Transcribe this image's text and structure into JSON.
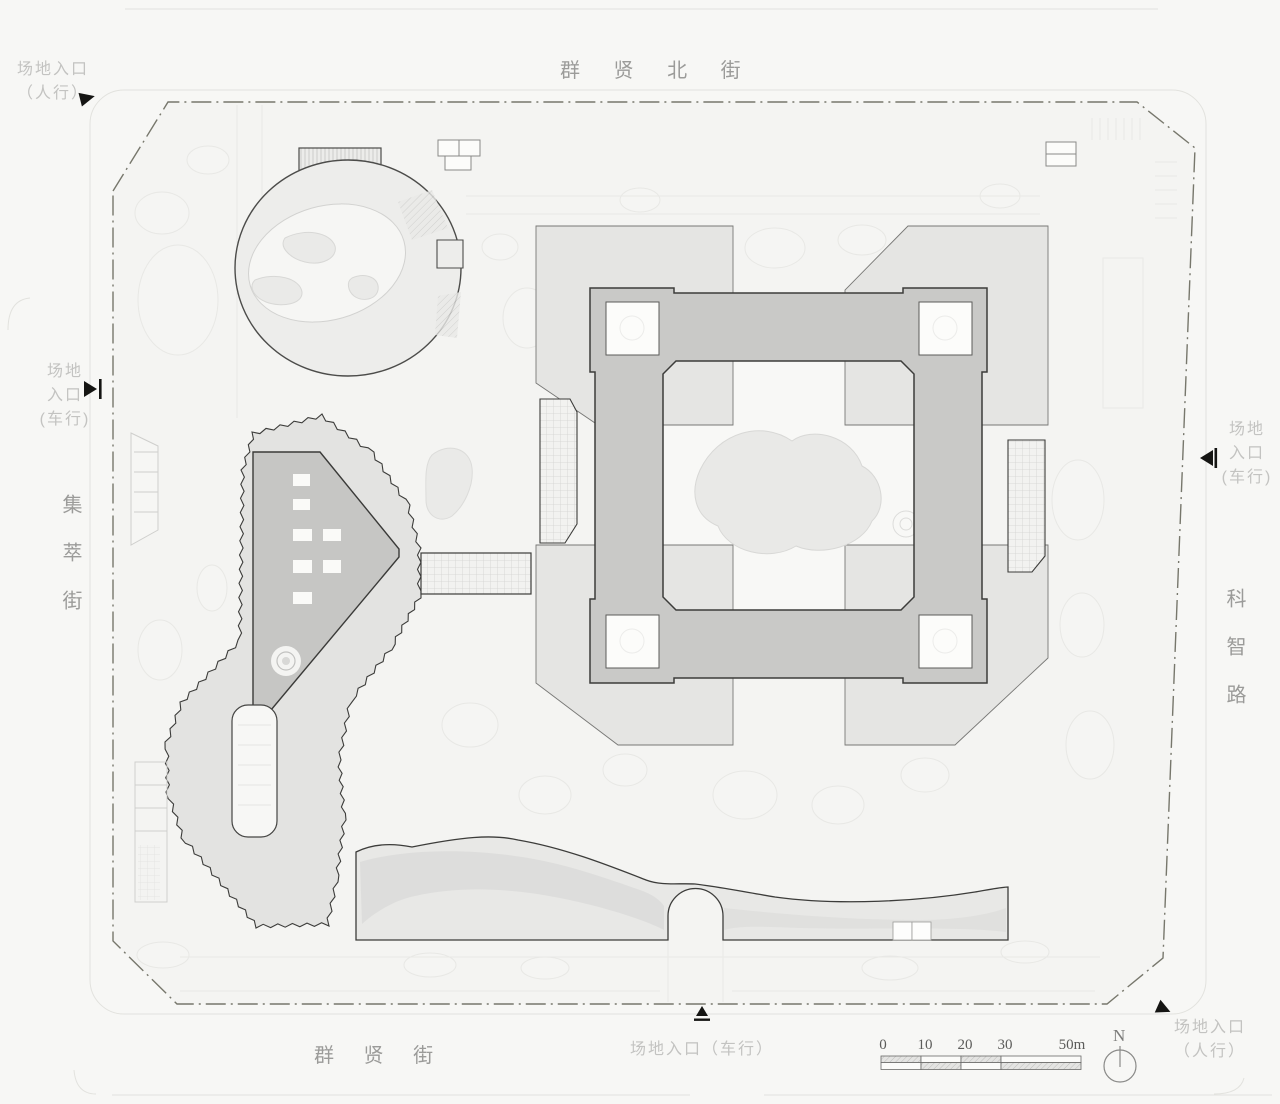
{
  "streets": {
    "north": "群 贤 北 街",
    "south": "群 贤 街",
    "west": "集萃街",
    "east": "科智路"
  },
  "entrances": {
    "northwest_pedestrian_line1": "场地入口",
    "northwest_pedestrian_line2": "（人行）",
    "west_vehicular_line1": "场地",
    "west_vehicular_line2": "入口",
    "west_vehicular_line3": "(车行)",
    "east_vehicular_line1": "场地",
    "east_vehicular_line2": "入口",
    "east_vehicular_line3": "(车行)",
    "south_vehicular": "场地入口（车行）",
    "southeast_pedestrian_line1": "场地入口",
    "southeast_pedestrian_line2": "（人行）"
  },
  "scale_bar": {
    "ticks": [
      "0",
      "10",
      "20",
      "30",
      "50m"
    ]
  },
  "compass": {
    "north_label": "N"
  },
  "colors": {
    "ring_building": "#c9c9c7",
    "inner_building": "#c6c6c4",
    "podium": "#e5e5e3",
    "zigzag_band": "#e3e3e1",
    "fan_building": "#ededeb",
    "canopy_band": "#e8e8e6",
    "outline_dark": "#3c3c3a",
    "boundary": "#77776c",
    "marker_black": "#151513"
  }
}
